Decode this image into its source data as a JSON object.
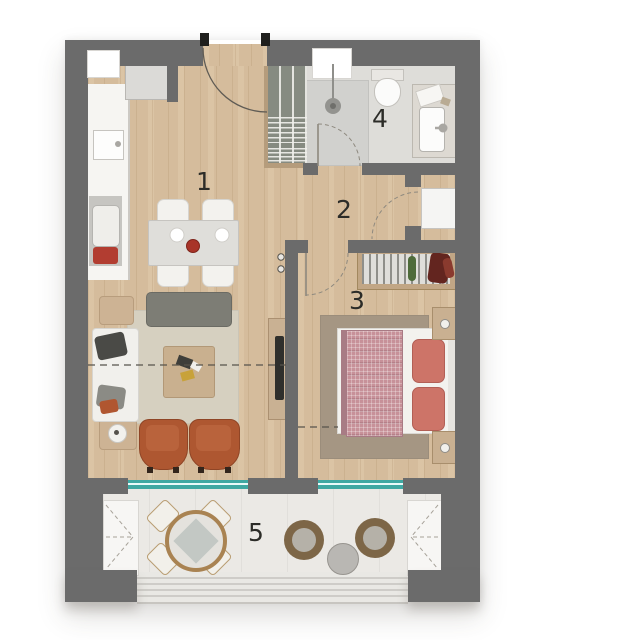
{
  "plan_title": "apartment-floor-plan",
  "rooms": [
    {
      "id": "living-dining-kitchen",
      "label": "1"
    },
    {
      "id": "hallway",
      "label": "2"
    },
    {
      "id": "bedroom",
      "label": "3"
    },
    {
      "id": "bathroom",
      "label": "4"
    },
    {
      "id": "balcony",
      "label": "5"
    }
  ],
  "colors": {
    "wall": "#6b6b6b",
    "wood_floor": "#d9c09f",
    "tile_floor": "#deddd9",
    "balcony_floor": "#ebe9e5",
    "window_door_accent_teal": "#3fa8a2",
    "armchair_orange": "#ae5731",
    "sofa_gray": "#7d7d75",
    "bed_blanket_pink": "#c79199",
    "pillow_coral": "#cd7468",
    "living_rug": "#d6d0c0",
    "bedroom_rug": "#a59683"
  }
}
